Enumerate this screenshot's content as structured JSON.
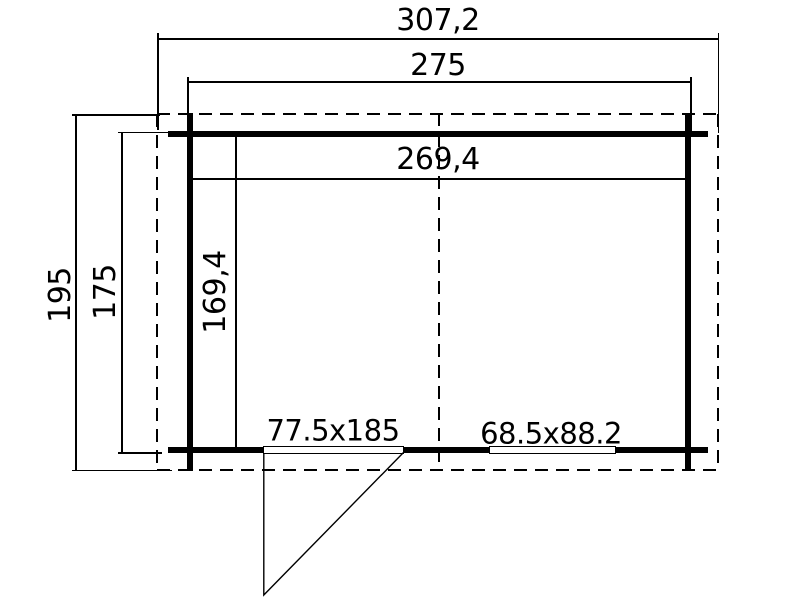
{
  "plan": {
    "type": "floor-plan",
    "colors": {
      "line": "#000000",
      "background": "#ffffff"
    },
    "labels": {
      "roof_width": "307,2",
      "outer_width": "275",
      "inner_width": "269,4",
      "roof_depth": "195",
      "outer_depth": "175",
      "inner_depth": "169,4",
      "door_size": "77.5x185",
      "window_size": "68.5x88.2"
    }
  }
}
